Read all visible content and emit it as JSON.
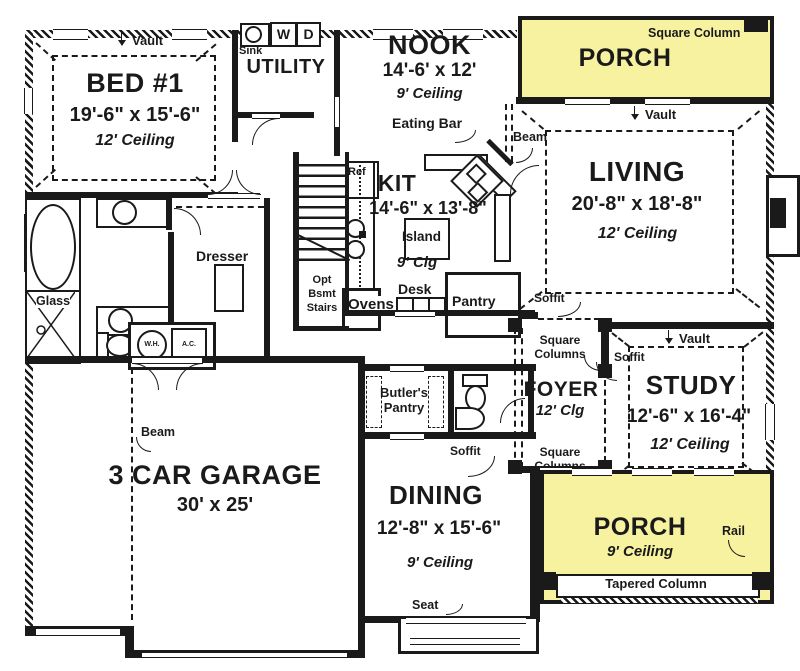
{
  "colors": {
    "porch_fill": "#F7F2A0",
    "ink": "#1a1a1a",
    "paper": "#ffffff"
  },
  "rooms": {
    "bed1": {
      "vault": "Vault",
      "name": "BED #1",
      "dims": "19'-6\" x 15'-6\"",
      "ceiling": "12' Ceiling"
    },
    "utility": {
      "name": "UTILITY",
      "sink": "Sink",
      "washer": "W",
      "dryer": "D"
    },
    "nook": {
      "name": "NOOK",
      "dims": "14'-6' x 12'",
      "ceiling": "9' Ceiling",
      "eating_bar": "Eating Bar"
    },
    "porch_top": {
      "name": "PORCH",
      "column": "Square Column"
    },
    "living": {
      "name": "LIVING",
      "dims": "20'-8\" x 18'-8\"",
      "ceiling": "12' Ceiling",
      "vault": "Vault",
      "beam": "Beam",
      "soffit": "Soffit"
    },
    "kitchen": {
      "name": "KIT",
      "dims": "14'-6\" x 13'-8\"",
      "ceiling": "9' Clg",
      "island": "Island",
      "desk": "Desk",
      "pantry": "Pantry",
      "ovens": "Ovens",
      "fridge": "Ref"
    },
    "stairs": {
      "l1": "Opt",
      "l2": "Bsmt",
      "l3": "Stairs"
    },
    "bath": {
      "glass": "Glass",
      "dresser": "Dresser",
      "water_heater": "W.H.",
      "air_conditioner": "A.C."
    },
    "garage": {
      "name": "3 CAR GARAGE",
      "dims": "30' x 25'",
      "beam": "Beam"
    },
    "butlers_pantry": {
      "l1": "Butler's",
      "l2": "Pantry"
    },
    "foyer": {
      "name": "FOYER",
      "ceiling": "12' Clg",
      "columns_upper_l1": "Square",
      "columns_upper_l2": "Columns",
      "columns_lower_l1": "Square",
      "columns_lower_l2": "Columns"
    },
    "study": {
      "name": "STUDY",
      "dims": "12'-6\" x 16'-4\"",
      "ceiling": "12' Ceiling",
      "vault": "Vault",
      "soffit": "Soffit"
    },
    "dining": {
      "name": "DINING",
      "dims": "12'-8\" x 15'-6\"",
      "ceiling": "9' Ceiling",
      "soffit": "Soffit",
      "seat": "Seat"
    },
    "porch_bottom": {
      "name": "PORCH",
      "ceiling": "9' Ceiling",
      "rail": "Rail",
      "tapered_column": "Tapered Column"
    }
  }
}
